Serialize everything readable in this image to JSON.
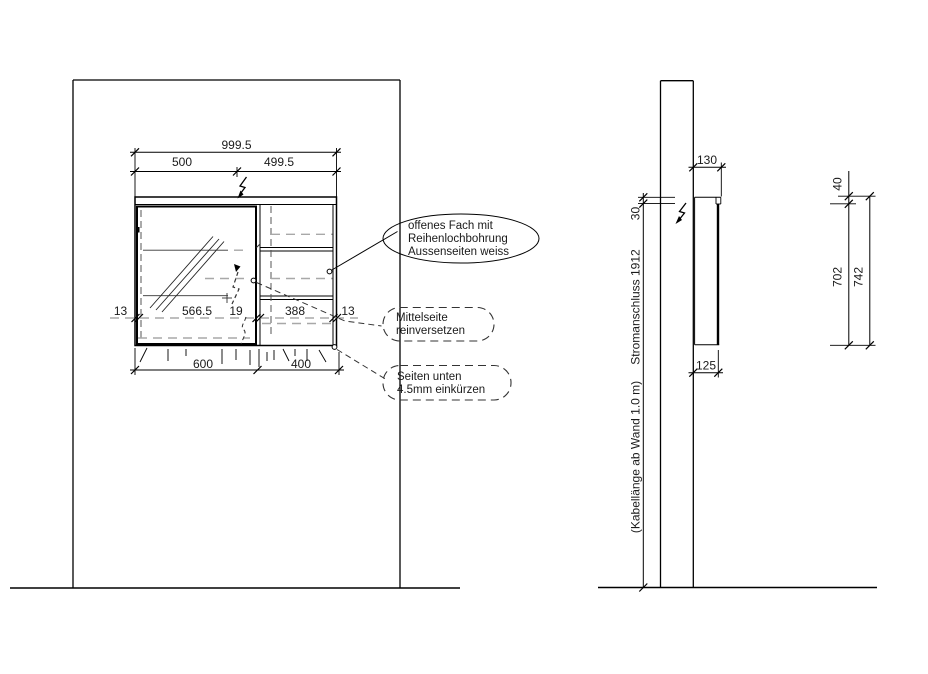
{
  "front_view": {
    "dim_total_width": "999.5",
    "dim_left_half": "500",
    "dim_right_half": "499.5",
    "dim_side_left": "13",
    "dim_door": "566.5",
    "dim_mid": "19",
    "dim_open": "388",
    "dim_side_right": "13",
    "dim_bottom_left": "600",
    "dim_bottom_right": "400"
  },
  "side_view": {
    "dim_depth_top": "130",
    "dim_power_offset": "30",
    "dim_depth_bottom": "125",
    "dim_top_gap": "40",
    "dim_body_height": "702",
    "dim_total_height": "742",
    "label_power": "Stromanschluss 1912",
    "label_cable": "(Kabellänge ab Wand 1.0 m)"
  },
  "callouts": {
    "open_shelf": {
      "line1": "offenes Fach mit",
      "line2": "Reihenlochbohrung",
      "line3": "Aussenseiten weiss"
    },
    "middle_panel": {
      "line1": "Mittelseite",
      "line2": "reinversetzen"
    },
    "sides_bottom": {
      "line1": "Seiten unten",
      "line2": "4.5mm einkürzen"
    }
  },
  "colors": {
    "line": "#000000",
    "hidden_gray": "#a8a8a8",
    "background": "#ffffff"
  }
}
